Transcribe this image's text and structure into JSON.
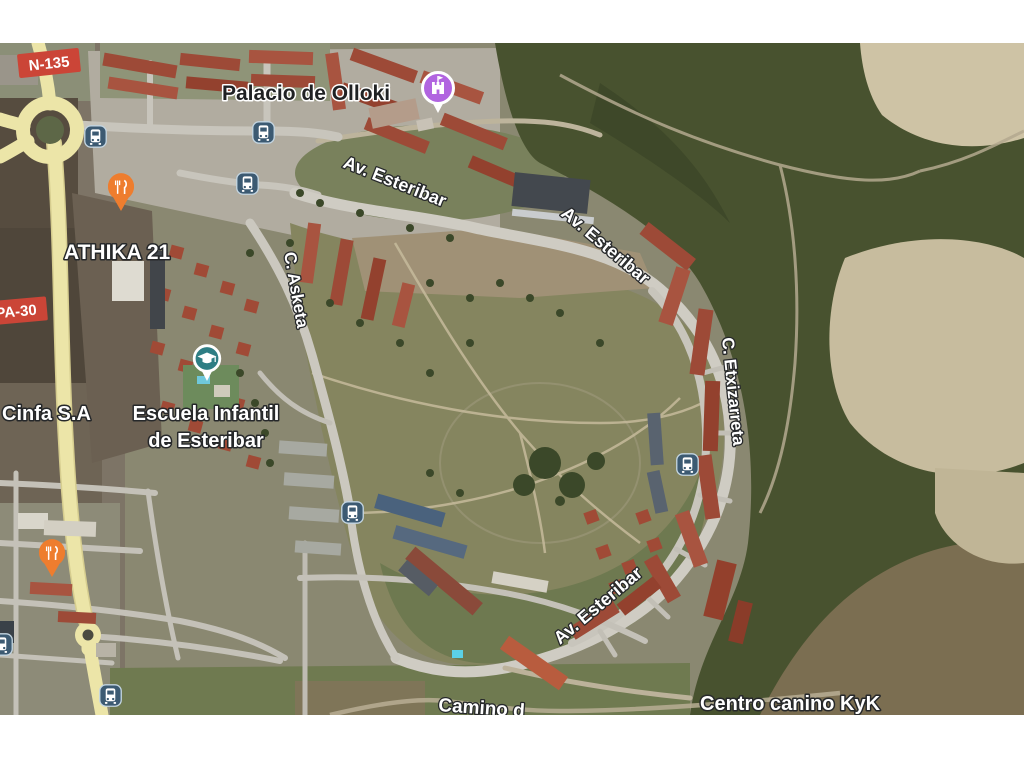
{
  "map": {
    "view_type": "satellite",
    "badges": {
      "n135": "N-135",
      "pa30": "PA-30"
    },
    "streets": {
      "av_esteribar_top": "Av. Esteribar",
      "av_esteribar_right": "Av. Esteribar",
      "av_esteribar_bottom": "Av. Esteribar",
      "c_asketa": "C. Asketa",
      "c_etxizarreta": "C. Etxizarreta",
      "camino": "Camino d"
    },
    "places": {
      "palacio": "Palacio de Olloki",
      "athika": "ATHIKA 21",
      "cinfa": "Cinfa S.A",
      "escuela_line1": "Escuela Infantil",
      "escuela_line2": "de Esteribar",
      "centro_canino": "Centro canino KyK"
    },
    "icons": {
      "bus_stop": "bus-stop-icon",
      "restaurant": "restaurant-pin-icon",
      "palace": "palace-poi-icon",
      "school": "school-poi-icon"
    },
    "colors": {
      "badge_red": "#cb4537",
      "pin_orange": "#ee7d2e",
      "palace_purple": "#b164e0",
      "school_teal": "#2e7e84",
      "bus_blue": "#3c5a72",
      "highway_yellow": "#ece5a8"
    }
  }
}
